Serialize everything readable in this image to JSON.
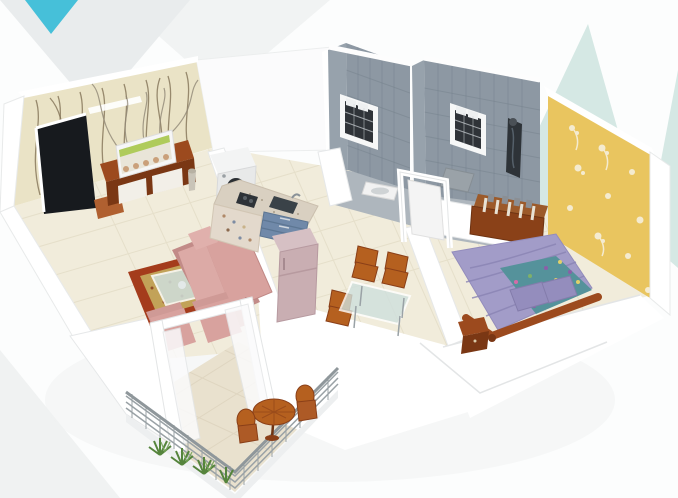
{
  "meta": {
    "description": "Photorealistic 3D isometric render of a 1 BHK apartment floor plan on a white background with decorative triangles",
    "view": "isometric-cutaway"
  },
  "colors": {
    "background": "#fcfdfd",
    "triangle_teal": "#46c0d9",
    "triangle_mint": "#d5e8e4",
    "triangle_gray": "#e9eced",
    "triangle_gray_light": "#f1f3f3",
    "wall_white": "#ffffff",
    "wall_top": "#f4f5f6",
    "floor_cream": "#f1ecdb",
    "floor_line": "#e3dcc6",
    "balcony_floor": "#e9e1ce",
    "wallpaper_cream": "#eae3c6",
    "entrance_door": "#171a1e",
    "door_mat": "#b06030",
    "bathroom_tile": "#8d98a3",
    "bathroom_tile_side": "#97a2ac",
    "bathroom_floor": "#aeb6bd",
    "window_grille": "#2f3338",
    "shower_panel": "#2e3338",
    "bedroom_wallpaper": "#e9c55f",
    "bed_blanket": "#a29cc8",
    "bed_pillow": "#948dbd",
    "bed_sheet": "#55929b",
    "wood": "#9c4a1e",
    "wood_dark": "#7a3714",
    "wood_rack": "#8a4118",
    "sofa": "#d8a29e",
    "sofa_shade": "#c28b88",
    "rug_border": "#a43c1c",
    "rug_center": "#c2a258",
    "glass": "#cfe0dd",
    "counter_granite": "#d9d0c1",
    "kitchen_drawers": "#7089a9",
    "sink": "#3a4248",
    "appliance_white": "#f3f4f4",
    "fridge": "#c9aeb2",
    "fridge_top": "#d6c0c4",
    "chair_orange": "#b5601f",
    "plant_green": "#55843c",
    "railing": "#9aa2a6",
    "tv_screen": "#e9e5d8"
  },
  "scene": {
    "label": "1 BHK apartment 3D floor plan",
    "background_decorations": [
      "gray-triangles-top-left",
      "teal-triangle-top-left",
      "mint-triangles-top-right",
      "gray-triangle-bottom-left"
    ],
    "rooms": [
      {
        "id": "living-room",
        "items": [
          "entrance-door",
          "door-mat",
          "tv-unit",
          "television",
          "l-shaped-sofa",
          "armchair",
          "armchair",
          "carpet-rug",
          "glass-coffee-table",
          "balcony-door-frame"
        ]
      },
      {
        "id": "kitchen",
        "items": [
          "l-shaped-counter",
          "sink",
          "gas-stove",
          "drawer-cabinets",
          "washing-machine",
          "refrigerator"
        ]
      },
      {
        "id": "dining-area",
        "items": [
          "glass-dining-table",
          "dining-chair",
          "dining-chair",
          "dining-chair"
        ]
      },
      {
        "id": "bathroom-1",
        "items": [
          "ventilator-window",
          "squat-toilet",
          "door-frame"
        ]
      },
      {
        "id": "bathroom-2",
        "items": [
          "ventilator-window",
          "shower-panel",
          "bath-mat"
        ]
      },
      {
        "id": "bedroom",
        "items": [
          "double-bed",
          "pillows",
          "wooden-storage-rack",
          "bedside-table",
          "floral-wallpaper-wall"
        ]
      },
      {
        "id": "balcony",
        "items": [
          "metal-railing",
          "round-patio-table",
          "patio-chair",
          "patio-chair",
          "plants"
        ]
      }
    ]
  }
}
